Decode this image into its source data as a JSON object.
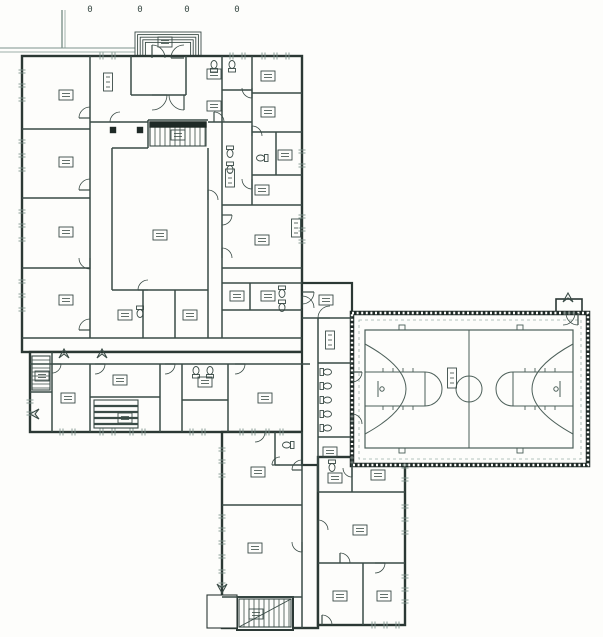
{
  "palette": {
    "paper": "#fdfdfb",
    "ink": "#3a4b46",
    "wall": "#2b3834",
    "dark": "#1f2a27",
    "light": "#7d938c",
    "dash": "#9cafa9",
    "court": "#4c5f59",
    "fill": "#fdfdfb"
  },
  "canvas": {
    "w": 603,
    "h": 637
  },
  "site_markers": [
    {
      "x": 90,
      "y": 12,
      "t": "0"
    },
    {
      "x": 140,
      "y": 12,
      "t": "0"
    },
    {
      "x": 187,
      "y": 12,
      "t": "0"
    },
    {
      "x": 237,
      "y": 12,
      "t": "0"
    }
  ],
  "polylines": [
    {
      "pts": [
        [
          62,
          10
        ],
        [
          62,
          48
        ]
      ],
      "w": 1.4
    },
    {
      "pts": [
        [
          65,
          10
        ],
        [
          65,
          48
        ]
      ],
      "w": 0.7
    },
    {
      "pts": [
        [
          0,
          48
        ],
        [
          135,
          48
        ]
      ],
      "w": 1.1
    },
    {
      "pts": [
        [
          0,
          52
        ],
        [
          135,
          52
        ]
      ],
      "w": 0.7
    }
  ],
  "entry_steps": {
    "x": 135,
    "y": 32,
    "w": 66,
    "h": 24,
    "n": 5,
    "inset": 2.6
  },
  "blocks": [
    {
      "name": "block-main",
      "x": 22,
      "y": 56,
      "w": 280,
      "h": 296,
      "w2": 2.4
    },
    {
      "name": "block-southwest-wing",
      "x": 30,
      "y": 352,
      "w": 280,
      "h": 80,
      "w2": 2.4
    },
    {
      "name": "block-south-wing",
      "x": 222,
      "y": 432,
      "w": 96,
      "h": 196,
      "w2": 2.4
    },
    {
      "name": "block-south-stair",
      "x": 237,
      "y": 597,
      "w": 56,
      "h": 33,
      "w2": 2
    },
    {
      "name": "block-south-porch",
      "x": 207,
      "y": 595,
      "w": 30,
      "h": 33,
      "w2": 1.1
    },
    {
      "name": "block-connector",
      "x": 302,
      "y": 283,
      "w": 50,
      "h": 182,
      "w2": 2.2
    },
    {
      "name": "block-southeast-wing",
      "x": 318,
      "y": 457,
      "w": 87,
      "h": 168,
      "w2": 2.4
    },
    {
      "name": "block-gym-vestibule",
      "x": 556,
      "y": 299,
      "w": 26,
      "h": 14,
      "w2": 1.6
    }
  ],
  "gym": {
    "outer": {
      "x": 352,
      "y": 313,
      "w": 236,
      "h": 152
    },
    "inner_dash": {
      "x": 359,
      "y": 320,
      "w": 222,
      "h": 139
    }
  },
  "walls": [
    [
      90,
      56,
      90,
      338
    ],
    [
      22,
      129,
      90,
      129
    ],
    [
      22,
      198,
      90,
      198
    ],
    [
      22,
      268,
      90,
      268
    ],
    [
      22,
      338,
      302,
      338
    ],
    [
      131,
      56,
      131,
      95
    ],
    [
      186,
      56,
      186,
      95
    ],
    [
      131,
      95,
      186,
      95
    ],
    [
      90,
      122,
      148,
      122
    ],
    [
      208,
      122,
      252,
      122
    ],
    [
      222,
      56,
      222,
      338
    ],
    [
      252,
      56,
      252,
      205
    ],
    [
      222,
      90,
      252,
      90
    ],
    [
      252,
      93,
      302,
      93
    ],
    [
      252,
      132,
      302,
      132
    ],
    [
      252,
      175,
      302,
      175
    ],
    [
      276,
      132,
      276,
      175
    ],
    [
      222,
      205,
      302,
      205
    ],
    [
      222,
      268,
      302,
      268
    ],
    [
      222,
      283,
      302,
      283
    ],
    [
      250,
      283,
      250,
      310
    ],
    [
      222,
      310,
      302,
      310
    ],
    [
      112,
      148,
      112,
      290
    ],
    [
      112,
      290,
      208,
      290
    ],
    [
      112,
      148,
      148,
      148
    ],
    [
      208,
      148,
      208,
      338
    ],
    [
      148,
      120,
      148,
      148
    ],
    [
      148,
      120,
      208,
      120
    ],
    [
      143,
      290,
      143,
      338
    ],
    [
      175,
      290,
      175,
      338
    ],
    [
      30,
      364,
      310,
      364
    ],
    [
      52,
      352,
      52,
      432
    ],
    [
      90,
      364,
      90,
      432
    ],
    [
      160,
      364,
      160,
      432
    ],
    [
      182,
      364,
      182,
      432
    ],
    [
      228,
      364,
      228,
      432
    ],
    [
      30,
      392,
      52,
      392
    ],
    [
      90,
      397,
      160,
      397
    ],
    [
      182,
      400,
      228,
      400
    ],
    [
      302,
      432,
      302,
      628
    ],
    [
      222,
      505,
      302,
      505
    ],
    [
      275,
      432,
      275,
      465
    ],
    [
      275,
      465,
      302,
      465
    ],
    [
      222,
      597,
      302,
      597
    ],
    [
      302,
      318,
      352,
      318
    ],
    [
      318,
      363,
      352,
      363
    ],
    [
      318,
      318,
      318,
      492
    ],
    [
      318,
      437,
      352,
      437
    ],
    [
      352,
      457,
      352,
      492
    ],
    [
      318,
      492,
      405,
      492
    ],
    [
      318,
      563,
      405,
      563
    ],
    [
      363,
      563,
      363,
      625
    ]
  ],
  "doors": [
    [
      90,
      118,
      11,
      180,
      270
    ],
    [
      90,
      190,
      11,
      180,
      270
    ],
    [
      90,
      258,
      11,
      90,
      180
    ],
    [
      90,
      330,
      11,
      180,
      270
    ],
    [
      152,
      95,
      15,
      0,
      90
    ],
    [
      184,
      95,
      15,
      90,
      180
    ],
    [
      152,
      58,
      13,
      270,
      360
    ],
    [
      184,
      58,
      13,
      180,
      270
    ],
    [
      120,
      122,
      10,
      180,
      270
    ],
    [
      214,
      122,
      10,
      270,
      360
    ],
    [
      252,
      88,
      10,
      90,
      180
    ],
    [
      252,
      136,
      10,
      270,
      360
    ],
    [
      252,
      179,
      10,
      90,
      180
    ],
    [
      222,
      215,
      10,
      0,
      90
    ],
    [
      222,
      258,
      10,
      270,
      360
    ],
    [
      208,
      200,
      10,
      270,
      360
    ],
    [
      148,
      290,
      10,
      180,
      270
    ],
    [
      302,
      292,
      12,
      0,
      90
    ],
    [
      302,
      308,
      12,
      270,
      360
    ],
    [
      330,
      318,
      12,
      180,
      270
    ],
    [
      352,
      372,
      10,
      0,
      90
    ],
    [
      352,
      424,
      10,
      270,
      360
    ],
    [
      52,
      364,
      9,
      0,
      90
    ],
    [
      95,
      364,
      10,
      0,
      90
    ],
    [
      165,
      364,
      10,
      0,
      90
    ],
    [
      235,
      364,
      10,
      0,
      90
    ],
    [
      255,
      432,
      10,
      0,
      90
    ],
    [
      302,
      470,
      10,
      180,
      270
    ],
    [
      302,
      542,
      10,
      90,
      180
    ],
    [
      280,
      465,
      8,
      180,
      270
    ],
    [
      352,
      468,
      9,
      90,
      180
    ],
    [
      318,
      530,
      10,
      270,
      360
    ],
    [
      340,
      563,
      10,
      270,
      360
    ],
    [
      375,
      563,
      10,
      0,
      90
    ],
    [
      322,
      625,
      10,
      270,
      360
    ],
    [
      563,
      313,
      12,
      0,
      90
    ],
    [
      578,
      313,
      12,
      90,
      180
    ]
  ],
  "ext_door_marks": [
    {
      "x": 64,
      "y": 349,
      "r": 0
    },
    {
      "x": 102,
      "y": 349,
      "r": 0
    },
    {
      "x": 30,
      "y": 414,
      "r": 270
    },
    {
      "x": 568,
      "y": 293,
      "r": 0
    },
    {
      "x": 222,
      "y": 593,
      "r": 180
    }
  ],
  "windows": [
    [
      22,
      70,
      "v"
    ],
    [
      22,
      84,
      "v"
    ],
    [
      22,
      98,
      "v"
    ],
    [
      22,
      140,
      "v"
    ],
    [
      22,
      154,
      "v"
    ],
    [
      22,
      168,
      "v"
    ],
    [
      22,
      210,
      "v"
    ],
    [
      22,
      224,
      "v"
    ],
    [
      22,
      238,
      "v"
    ],
    [
      22,
      280,
      "v"
    ],
    [
      22,
      294,
      "v"
    ],
    [
      22,
      308,
      "v"
    ],
    [
      100,
      56,
      "h"
    ],
    [
      112,
      56,
      "h"
    ],
    [
      230,
      56,
      "h"
    ],
    [
      242,
      56,
      "h"
    ],
    [
      262,
      56,
      "h"
    ],
    [
      274,
      56,
      "h"
    ],
    [
      286,
      56,
      "h"
    ],
    [
      302,
      150,
      "v"
    ],
    [
      302,
      164,
      "v"
    ],
    [
      302,
      215,
      "v"
    ],
    [
      302,
      228,
      "v"
    ],
    [
      302,
      240,
      "v"
    ],
    [
      60,
      432,
      "h"
    ],
    [
      72,
      432,
      "h"
    ],
    [
      100,
      432,
      "h"
    ],
    [
      112,
      432,
      "h"
    ],
    [
      130,
      432,
      "h"
    ],
    [
      142,
      432,
      "h"
    ],
    [
      190,
      432,
      "h"
    ],
    [
      202,
      432,
      "h"
    ],
    [
      240,
      432,
      "h"
    ],
    [
      252,
      432,
      "h"
    ],
    [
      266,
      432,
      "h"
    ],
    [
      280,
      432,
      "h"
    ],
    [
      30,
      400,
      "v"
    ],
    [
      30,
      412,
      "v"
    ],
    [
      222,
      448,
      "v"
    ],
    [
      222,
      460,
      "v"
    ],
    [
      222,
      474,
      "v"
    ],
    [
      222,
      515,
      "v"
    ],
    [
      222,
      528,
      "v"
    ],
    [
      222,
      541,
      "v"
    ],
    [
      222,
      555,
      "v"
    ],
    [
      222,
      570,
      "v"
    ],
    [
      222,
      583,
      "v"
    ],
    [
      405,
      465,
      "v"
    ],
    [
      405,
      478,
      "v"
    ],
    [
      405,
      505,
      "v"
    ],
    [
      405,
      518,
      "v"
    ],
    [
      405,
      531,
      "v"
    ],
    [
      405,
      575,
      "v"
    ],
    [
      405,
      588,
      "v"
    ],
    [
      405,
      600,
      "v"
    ],
    [
      372,
      625,
      "h"
    ],
    [
      384,
      625,
      "h"
    ],
    [
      396,
      625,
      "h"
    ]
  ],
  "labels": [
    [
      66,
      95,
      "h"
    ],
    [
      66,
      162,
      "h"
    ],
    [
      66,
      232,
      "h"
    ],
    [
      66,
      300,
      "h"
    ],
    [
      108,
      82,
      "v"
    ],
    [
      214,
      74,
      "h"
    ],
    [
      214,
      106,
      "h"
    ],
    [
      268,
      76,
      "h"
    ],
    [
      268,
      112,
      "h"
    ],
    [
      285,
      155,
      "h"
    ],
    [
      230,
      178,
      "v"
    ],
    [
      262,
      190,
      "h"
    ],
    [
      160,
      235,
      "h"
    ],
    [
      262,
      240,
      "h"
    ],
    [
      237,
      296,
      "h"
    ],
    [
      268,
      296,
      "h"
    ],
    [
      125,
      315,
      "h"
    ],
    [
      190,
      315,
      "h"
    ],
    [
      296,
      228,
      "v"
    ],
    [
      178,
      135,
      "h"
    ],
    [
      165,
      42,
      "h"
    ],
    [
      42,
      376,
      "h"
    ],
    [
      68,
      398,
      "h"
    ],
    [
      120,
      380,
      "h"
    ],
    [
      125,
      418,
      "h"
    ],
    [
      205,
      382,
      "h"
    ],
    [
      265,
      398,
      "h"
    ],
    [
      258,
      472,
      "h"
    ],
    [
      255,
      548,
      "h"
    ],
    [
      256,
      614,
      "h"
    ],
    [
      330,
      452,
      "h"
    ],
    [
      330,
      340,
      "v"
    ],
    [
      326,
      300,
      "h"
    ],
    [
      335,
      478,
      "h"
    ],
    [
      378,
      475,
      "h"
    ],
    [
      360,
      530,
      "h"
    ],
    [
      340,
      596,
      "h"
    ],
    [
      384,
      596,
      "h"
    ]
  ],
  "fixtures": [
    [
      214,
      66,
      180
    ],
    [
      232,
      66,
      180
    ],
    [
      262,
      158,
      90
    ],
    [
      230,
      152,
      0
    ],
    [
      230,
      168,
      0
    ],
    [
      282,
      292,
      0
    ],
    [
      282,
      306,
      0
    ],
    [
      196,
      372,
      180
    ],
    [
      210,
      372,
      180
    ],
    [
      326,
      372,
      270
    ],
    [
      326,
      386,
      270
    ],
    [
      326,
      400,
      270
    ],
    [
      326,
      414,
      270
    ],
    [
      326,
      428,
      270
    ],
    [
      288,
      445,
      90
    ],
    [
      332,
      466,
      0
    ],
    [
      140,
      312,
      0
    ]
  ],
  "columns": [
    [
      113,
      130
    ],
    [
      140,
      130
    ]
  ],
  "stairs": [
    {
      "x": 150,
      "y": 122,
      "w": 56,
      "h": 24,
      "step": 5,
      "dir": "v",
      "band": true,
      "diag": false,
      "thick": false
    },
    {
      "x": 239,
      "y": 599,
      "w": 52,
      "h": 28,
      "step": 5,
      "dir": "v",
      "band": false,
      "diag": true,
      "thick": false
    },
    {
      "x": 32,
      "y": 356,
      "w": 18,
      "h": 34,
      "step": 4,
      "dir": "h",
      "band": false,
      "diag": false,
      "thick": false
    },
    {
      "x": 94,
      "y": 400,
      "w": 44,
      "h": 28,
      "step": 6,
      "dir": "h",
      "band": false,
      "diag": false,
      "thick": true
    }
  ],
  "court": {
    "boundary": {
      "x": 365,
      "y": 330,
      "w": 208,
      "h": 118
    },
    "lines": [
      [
        469,
        330,
        469,
        448
      ],
      [
        365,
        372,
        425,
        372
      ],
      [
        425,
        372,
        425,
        406
      ],
      [
        365,
        406,
        425,
        406
      ],
      [
        513,
        372,
        573,
        372
      ],
      [
        513,
        372,
        513,
        406
      ],
      [
        513,
        406,
        573,
        406
      ],
      [
        378,
        381,
        378,
        397
      ],
      [
        560,
        381,
        560,
        397
      ]
    ],
    "paths": [
      "M425,372 A17,17 0 0 1 425,406",
      "M513,372 A17,17 0 0 0 513,406",
      "M365,344 Q447,389 365,434",
      "M573,344 Q491,389 573,434"
    ],
    "circles": [
      [
        469,
        389,
        13
      ],
      [
        382,
        389,
        2.2
      ],
      [
        556,
        389,
        2.2
      ]
    ],
    "ticks": [
      [
        383,
        368,
        383,
        372
      ],
      [
        393,
        368,
        393,
        372
      ],
      [
        403,
        368,
        403,
        372
      ],
      [
        413,
        368,
        413,
        372
      ],
      [
        383,
        406,
        383,
        410
      ],
      [
        393,
        406,
        393,
        410
      ],
      [
        403,
        406,
        403,
        410
      ],
      [
        413,
        406,
        413,
        410
      ],
      [
        525,
        368,
        525,
        372
      ],
      [
        535,
        368,
        535,
        372
      ],
      [
        545,
        368,
        545,
        372
      ],
      [
        555,
        368,
        555,
        372
      ],
      [
        525,
        406,
        525,
        410
      ],
      [
        535,
        406,
        535,
        410
      ],
      [
        545,
        406,
        545,
        410
      ],
      [
        555,
        406,
        555,
        410
      ]
    ],
    "blocks": [
      [
        399,
        325,
        6,
        5
      ],
      [
        517,
        325,
        6,
        5
      ],
      [
        399,
        448,
        6,
        5
      ],
      [
        517,
        448,
        6,
        5
      ]
    ],
    "label": [
      452,
      377,
      "v"
    ]
  }
}
